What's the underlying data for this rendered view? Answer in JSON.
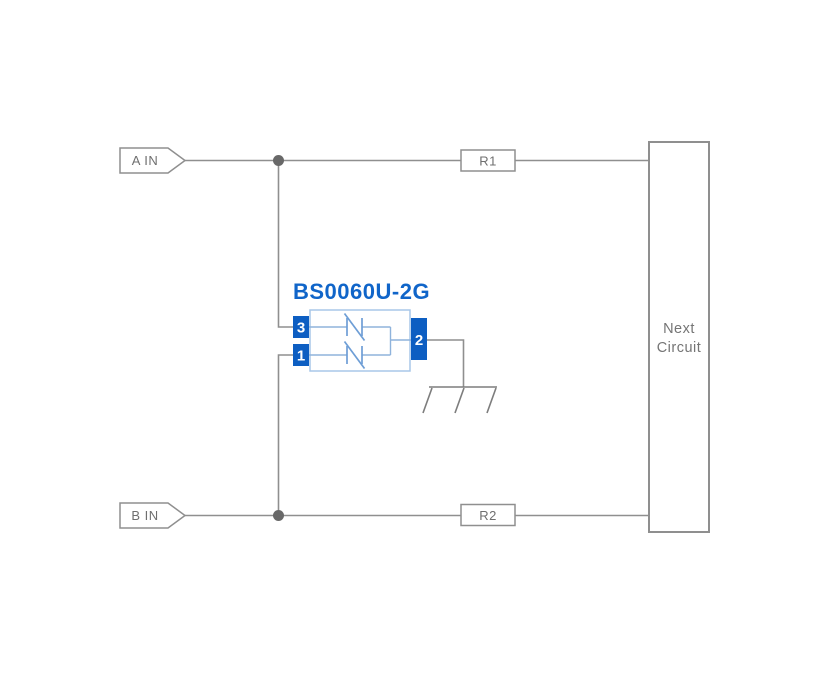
{
  "diagram": {
    "component": {
      "title": "BS0060U-2G",
      "pin3": "3",
      "pin1": "1",
      "pin2": "2"
    },
    "ports": {
      "a_in": "A IN",
      "b_in": "B IN"
    },
    "resistors": {
      "r1": "R1",
      "r2": "R2"
    },
    "next_circuit": {
      "line1": "Next",
      "line2": "Circuit"
    },
    "colors": {
      "background": "#ffffff",
      "wire": "#8f8f8f",
      "label_text": "#6f6f6f",
      "junction_dot": "#686868",
      "pin_fill": "#0d5ec2",
      "pin_text": "#ffffff",
      "component_outline": "#a9c7e8",
      "diode_blue": "#6e9ed6",
      "title_blue": "#1065c9"
    }
  }
}
